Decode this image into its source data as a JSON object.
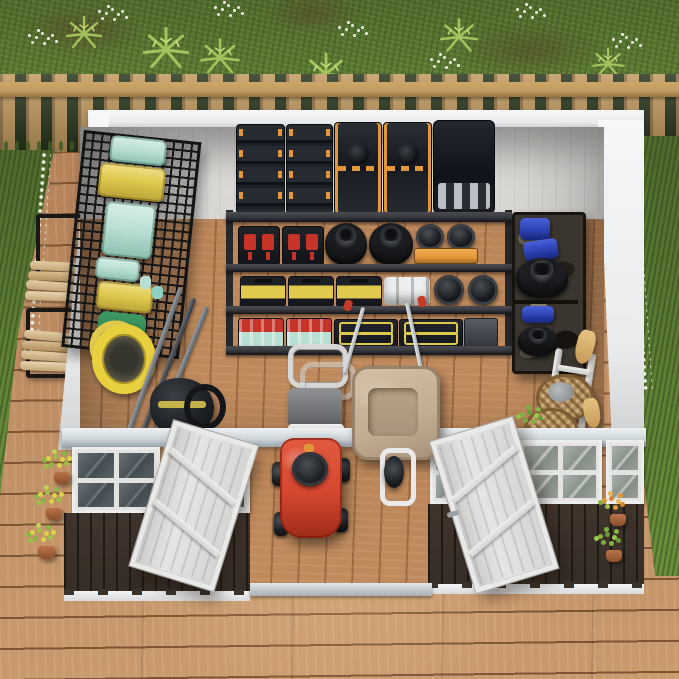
{
  "image": {
    "type": "3d-product-render",
    "description": "Top-down isometric cutaway render of a white and dark-brown metal garden storage shed with both front doors open, fully organized inside, standing on a brown wooden deck in a backyard bordered by a natural-wood picket fence, grass, ferns, white wildflowers and potted plants."
  },
  "labels": {
    "scene": "Backyard metal storage shed - isometric cutaway product render",
    "grass": "Backyard lawn with ferns and white wildflowers",
    "fence": "Natural wood picket fence",
    "deck": "Brown wooden plank deck",
    "lumber": "Black log rack with stacked firewood outside the left wall",
    "shed": "White metal shed shown in cutaway with dark brown front panels",
    "back_shelf": "Five-tier garage rack: stacked black and orange tool cases on top, boxes with red latches, piled tires and spare parts, yellow toolboxes, white rolls, wheel hubs, red and teal parts organizers and yellow-trimmed cases",
    "left_rack": "Black wire wall rack with yellow and mint storage totes and a green pressure washer with coiled yellow hose",
    "hose_reel": "Yellow garden hose reel on the left wall",
    "tools": "Long-handled garden tools with teal grips leaning on the left wall",
    "vac": "Black and yellow wet-dry vacuum",
    "cart": "Push lawn sweeper with grey catcher bag and silver handle",
    "wheelbarrow": "Beige wheelbarrow with silver handles and single front wheel",
    "mower": "Red walk-behind lawn mower parked in the doorway",
    "right_shelf": "Camouflage utility shelf with blue jugs, a blue bin and spare tires",
    "ladder": "White ladder leaning on the right wall",
    "baskets": "Wicker baskets with dried plants and garden accessories",
    "duster": "Tan grass broom by the right wall",
    "doors": "Two white panel doors swung open onto the deck",
    "threshold": "Aluminium door threshold",
    "windows_left": "Front-left windows with white frames",
    "windows_right": "Front-right windows with white frames",
    "plants_left": "Three terracotta pots with yellow-green flowers along the left front wall",
    "plants_right": "Two pots with orange and green plants along the right front wall"
  },
  "colors": {
    "grass-base": "#6c8f3c",
    "grass-dark": "#4e6a2c",
    "fence-wood": "#c19a5f",
    "fence-shadow": "#96753f",
    "fence-gap": "#27351d",
    "deck-wood": "#b5825a",
    "deck-light": "#c99a6e",
    "deck-seam": "#7d5434",
    "wall-white": "#e9ebec",
    "wall-edge": "#f6f7f8",
    "wall-inner": "#d8d6d3",
    "floor-wood": "#c08b5e",
    "floor-seam": "#8a5c38",
    "header-steel": "#ccd4da",
    "siding-brown": "#362d26",
    "siding-rib": "#201a15",
    "door-white": "#dadbd9",
    "shelf-frame": "#26282c",
    "shelf-board": "#3b3d42",
    "case-black": "#1e2228",
    "accent-orange": "#e2963a",
    "latch-red": "#c63429",
    "bin-yellow": "#dfc94e",
    "tote-teal": "#b9ded3",
    "machine-green": "#2f7c4e",
    "jug-blue": "#2a41b2",
    "mower-red": "#d5472f",
    "barrow-tan": "#c2ad92",
    "basket-tan": "#b08c5c",
    "silver": "#c9ced3",
    "mesh-black": "#161616"
  }
}
